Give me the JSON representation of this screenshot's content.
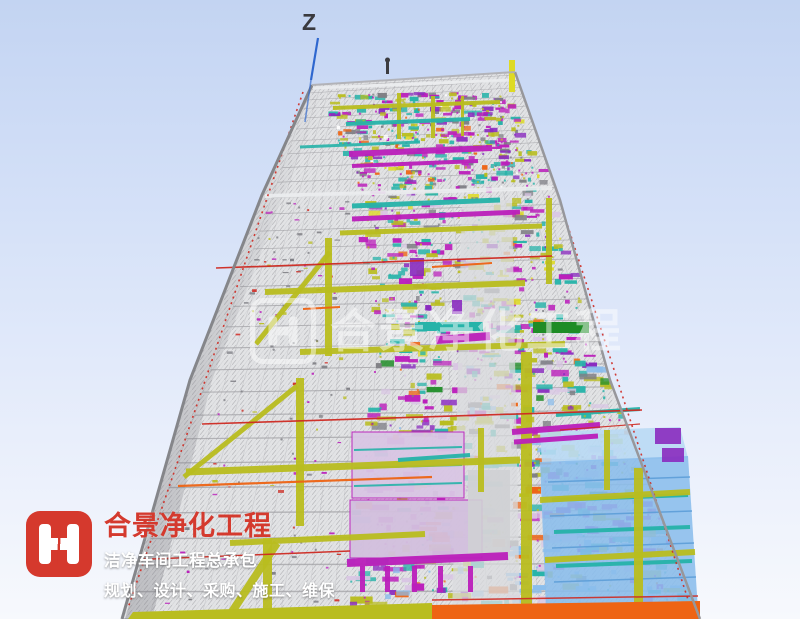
{
  "scene": {
    "axis_label": "Z"
  },
  "watermark": {
    "text": "合景净化工程"
  },
  "branding": {
    "title": "合景净化工程",
    "tagline": "洁净车间工程总承包",
    "services": "规划、设计、采购、施工、维保"
  },
  "colors": {
    "skyTop": "#c3d4f2",
    "skyMid": "#d5e1f8",
    "skyLow": "#e8eefb",
    "skyBottom": "#f7f9fd",
    "structure": "#e2e3e5",
    "meshLine": "#9c9ca2",
    "meshLight": "#c6c8cc",
    "edgeDark": "#85868a",
    "edgeMid": "#97979b",
    "floorLine": "#a2a2a6",
    "fanLine": "#b4b4b8",
    "slabLight": "#eceef0",
    "corridor": "#dadbdd",
    "olive": "#b9bd1f",
    "yellow": "#deda25",
    "magenta": "#bb1fbb",
    "purple": "#8a2bbf",
    "lavender": "#d9c6e4",
    "lavender2": "#d3c0de",
    "teal": "#26b3a9",
    "lightBlue": "#8abdec",
    "paleBlue": "#b9d9f4",
    "blueLine": "#5d9ed8",
    "green": "#1e8c26",
    "orange": "#ee6414",
    "redLine": "#cf2a22",
    "axisBlue": "#2e67cf",
    "brandRed": "#d5392d",
    "greyDark": "#7e7e84",
    "greyBlock": "#cfd0d4",
    "white": "#ffffff",
    "marker": "#3c3c40"
  }
}
